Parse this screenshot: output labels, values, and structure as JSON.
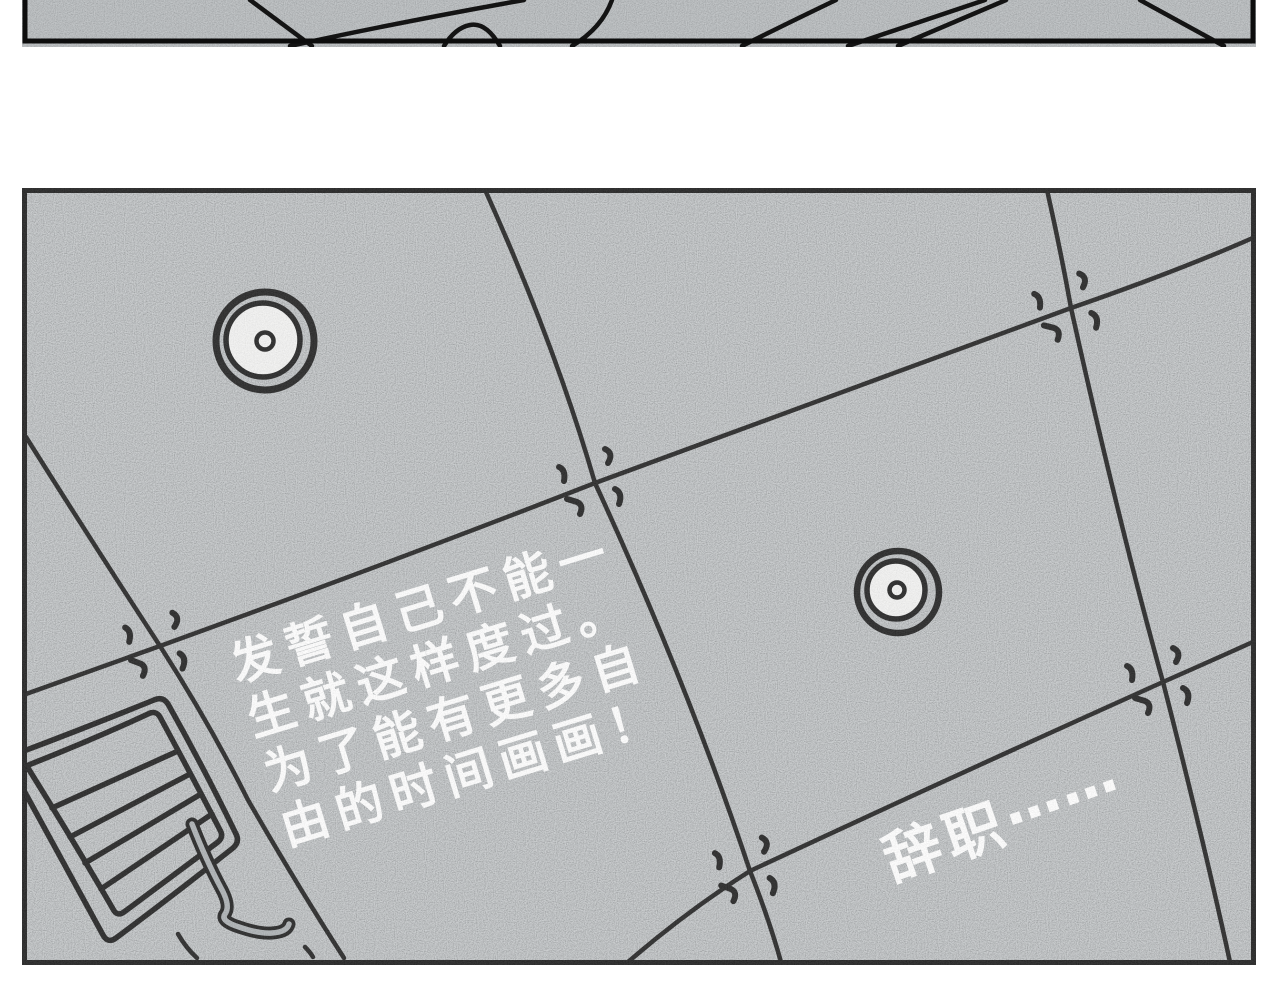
{
  "art_colors": {
    "page_background": "#ffffff",
    "paper_gray": "#a6abae",
    "ink_black": "#141414",
    "text_white": "#ffffff",
    "lamp_white": "#f2f2f1"
  },
  "main_panel": {
    "monologue": {
      "line1": "发誓自己不能一",
      "line2": "生就这样度过。",
      "line3": "为了能有更多自",
      "line4": "由的时间画画！"
    },
    "resign": {
      "text": "辞职",
      "ellipsis": "……"
    }
  }
}
